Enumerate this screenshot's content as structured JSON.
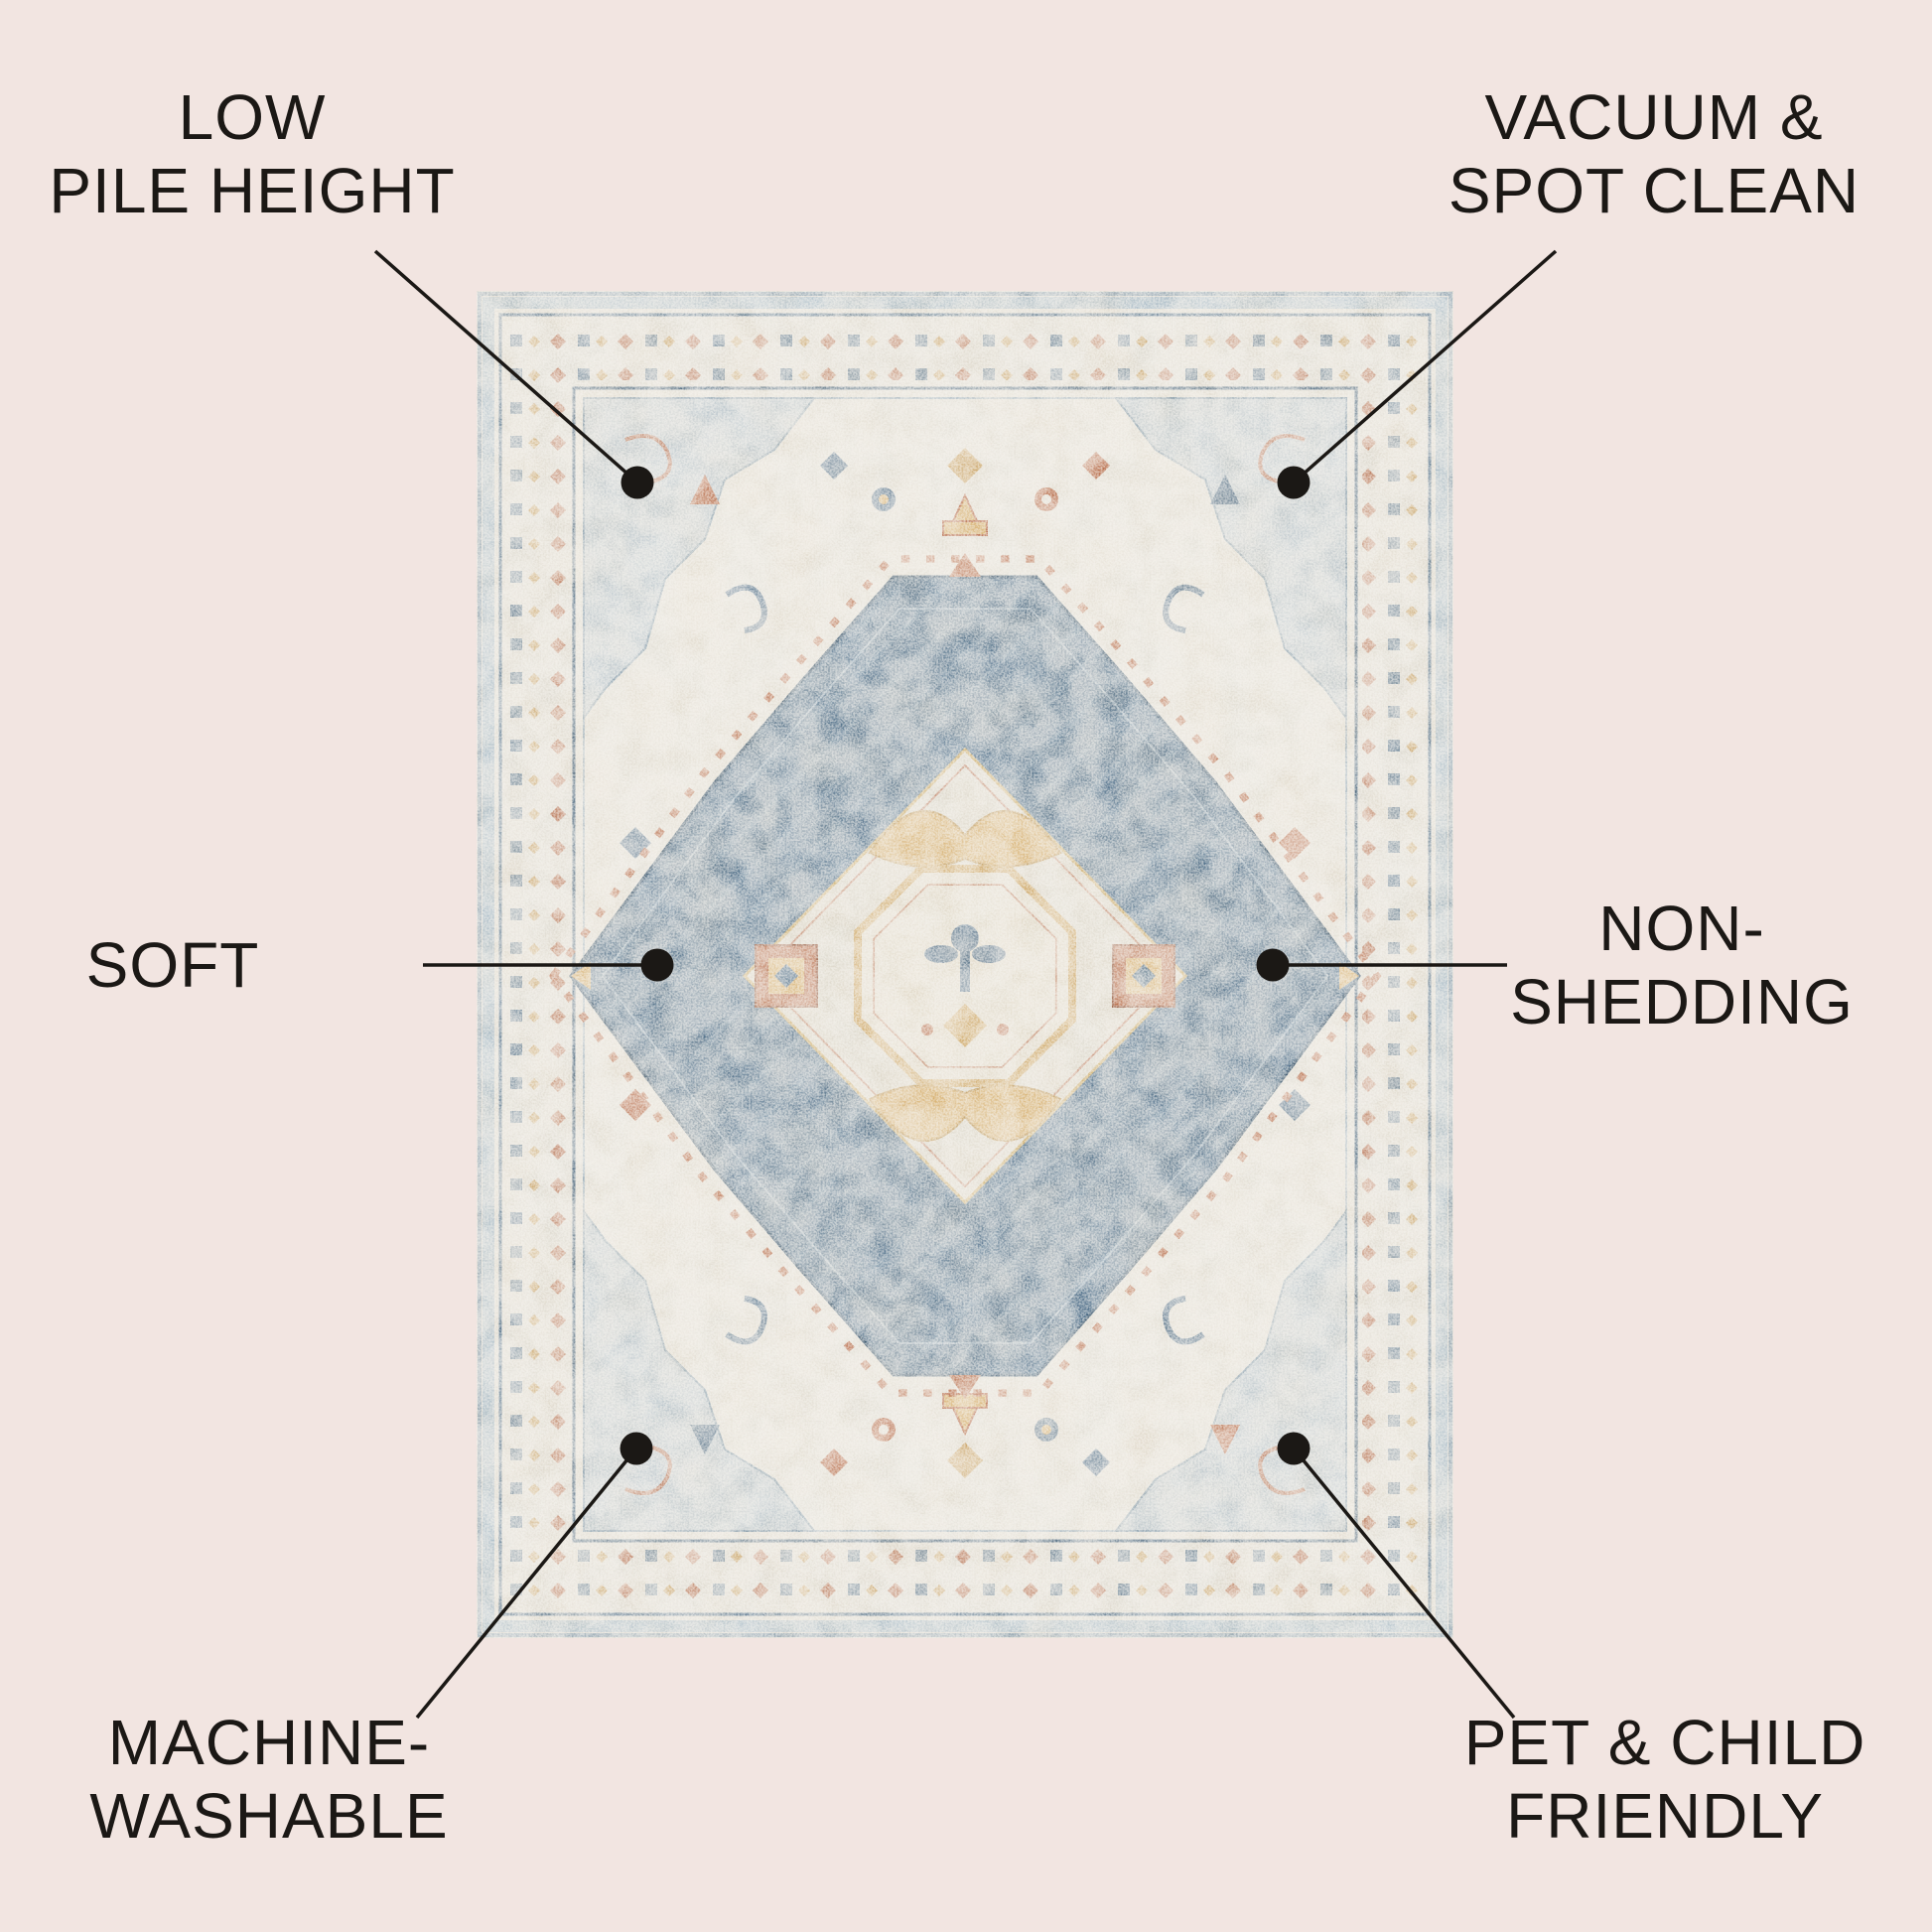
{
  "page": {
    "background_color": "#f2e5e1",
    "label_text_color": "#1b1815",
    "leader_line_color": "#1b1815"
  },
  "features": [
    {
      "id": "low-pile-height",
      "lines": [
        "LOW",
        "PILE HEIGHT"
      ]
    },
    {
      "id": "vacuum-spot-clean",
      "lines": [
        "VACUUM &",
        "SPOT CLEAN"
      ]
    },
    {
      "id": "soft",
      "lines": [
        "SOFT"
      ]
    },
    {
      "id": "non-shedding",
      "lines": [
        "NON-",
        "SHEDDING"
      ]
    },
    {
      "id": "machine-washable",
      "lines": [
        "MACHINE-",
        "WASHABLE"
      ]
    },
    {
      "id": "pet-child-friendly",
      "lines": [
        "PET & CHILD",
        "FRIENDLY"
      ]
    }
  ],
  "rug_palette": {
    "field_ivory": "#e3e0d7",
    "medallion_blue": "#50708b",
    "detail_navy": "#2e4d67",
    "accent_rust": "#b2603c",
    "accent_gold": "#d6ad68",
    "border_light_blue": "#a8bbc7",
    "spandrel_blue_gray": "#b9c6ce"
  }
}
